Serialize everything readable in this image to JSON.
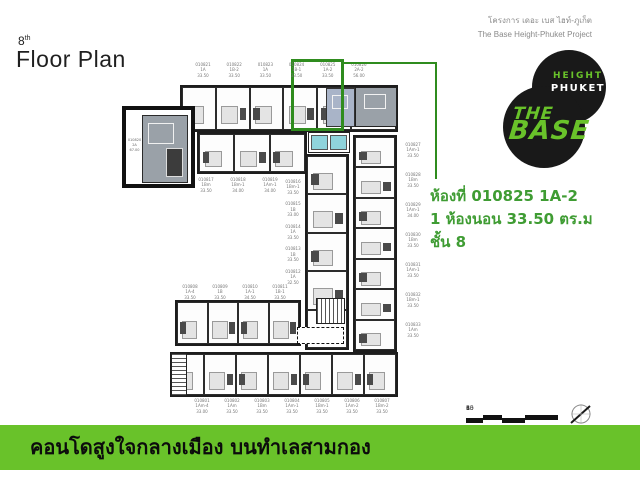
{
  "header": {
    "floor_number": "8",
    "floor_suffix": "th",
    "title": "Floor Plan",
    "project_name_th": "โครงการ เดอะ เบส ไฮท์-ภูเก็ต",
    "project_name_en": "The Base Height-Phuket Project"
  },
  "logo": {
    "height_label": "HEIGHT",
    "phuket_label": "PHUKET",
    "the_label": "THE",
    "base_label": "BASE"
  },
  "callout": {
    "room_line": "ห้องที่ 010825 1A-2",
    "bedroom_line": "1 ห้องนอน 33.50 ตร.ม",
    "floor_line": "ชั้น 8",
    "highlighted_unit": "010825"
  },
  "detail_box": {
    "no": "010820",
    "type": "2A",
    "area": "67.00"
  },
  "floor_plan": {
    "top_row": [
      {
        "no": "010821",
        "type": "1A",
        "area": "33.50"
      },
      {
        "no": "010822",
        "type": "1B-2",
        "area": "33.50"
      },
      {
        "no": "010823",
        "type": "1A",
        "area": "33.50"
      },
      {
        "no": "010824",
        "type": "1B-1",
        "area": "33.50"
      },
      {
        "no": "010825",
        "type": "1A-2",
        "area": "33.50"
      },
      {
        "no": "010826",
        "type": "2A-2",
        "area": "56.00"
      }
    ],
    "second_row": [
      {
        "no": "010817",
        "type": "1Bm",
        "area": "33.50"
      },
      {
        "no": "010818",
        "type": "1Bm-1",
        "area": "34.00"
      },
      {
        "no": "010819",
        "type": "1Am-1",
        "area": "34.00"
      }
    ],
    "mid_column": [
      {
        "no": "010816",
        "type": "1Bm-1",
        "area": "33.50"
      },
      {
        "no": "010815",
        "type": "1B",
        "area": "33.00"
      },
      {
        "no": "010814",
        "type": "1A",
        "area": "33.50"
      },
      {
        "no": "010813",
        "type": "1B",
        "area": "33.50"
      },
      {
        "no": "010812",
        "type": "1A",
        "area": "32.50"
      }
    ],
    "right_column": [
      {
        "no": "010827",
        "type": "1Am-1",
        "area": "33.50"
      },
      {
        "no": "010828",
        "type": "1Bm",
        "area": "33.50"
      },
      {
        "no": "010829",
        "type": "1Am-1",
        "area": "34.00"
      },
      {
        "no": "010830",
        "type": "1Bm",
        "area": "33.50"
      },
      {
        "no": "010831",
        "type": "1Am-1",
        "area": "33.50"
      },
      {
        "no": "010832",
        "type": "1Bm-1",
        "area": "33.50"
      },
      {
        "no": "010833",
        "type": "1Am",
        "area": "33.50"
      }
    ],
    "bottom_upper_row": [
      {
        "no": "010808",
        "type": "1A-4",
        "area": "33.50"
      },
      {
        "no": "010809",
        "type": "1B",
        "area": "33.50"
      },
      {
        "no": "010810",
        "type": "1A-1",
        "area": "34.50"
      },
      {
        "no": "010811",
        "type": "1B-1",
        "area": "33.50"
      }
    ],
    "bottom_lower_row": [
      {
        "no": "010801",
        "type": "1Am-4",
        "area": "33.00"
      },
      {
        "no": "010802",
        "type": "1Am",
        "area": "33.50"
      },
      {
        "no": "010803",
        "type": "1Bm",
        "area": "33.50"
      },
      {
        "no": "010804",
        "type": "1Am-1",
        "area": "33.50"
      },
      {
        "no": "010805",
        "type": "1Bm-1",
        "area": "33.50"
      },
      {
        "no": "010806",
        "type": "1Am-2",
        "area": "33.50"
      },
      {
        "no": "010807",
        "type": "1Bm-2",
        "area": "33.50"
      }
    ]
  },
  "scale_bar": {
    "ticks": [
      "1",
      "3",
      "6",
      "10",
      "15"
    ]
  },
  "footer": {
    "tagline": "คอนโดสูงใจกลางเมือง บนทำเลสามกอง"
  },
  "colors": {
    "accent_green": "#69c22a",
    "dark_green": "#2f8c1e",
    "text_green": "#3f9c33",
    "highlight_blue": "#a9b4c8",
    "highlight_gray": "#9aa1a8",
    "lift_cyan": "#8fd4dc"
  }
}
